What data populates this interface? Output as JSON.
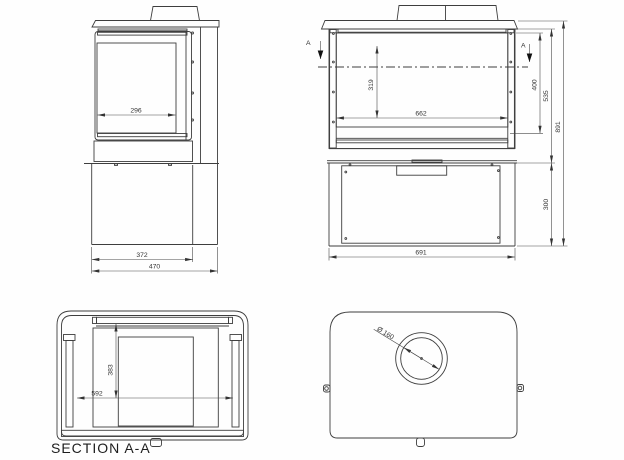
{
  "section": {
    "label": "SECTION A-A",
    "marker": "A"
  },
  "dims": {
    "side": {
      "window_width": "296",
      "base_depth": "372",
      "overall_depth": "470"
    },
    "front": {
      "inner_height": "319",
      "inner_width": "662",
      "opening_height": "400",
      "upper_height": "535",
      "overall_height": "891",
      "base_height": "300",
      "overall_width": "691"
    },
    "section_aa": {
      "depth": "383",
      "inner_width": "592"
    },
    "top": {
      "flue_diameter": "Ø 160"
    }
  },
  "colors": {
    "line": "#3e3e3e",
    "dark_fill": "#232323",
    "background": "#fefefe"
  }
}
